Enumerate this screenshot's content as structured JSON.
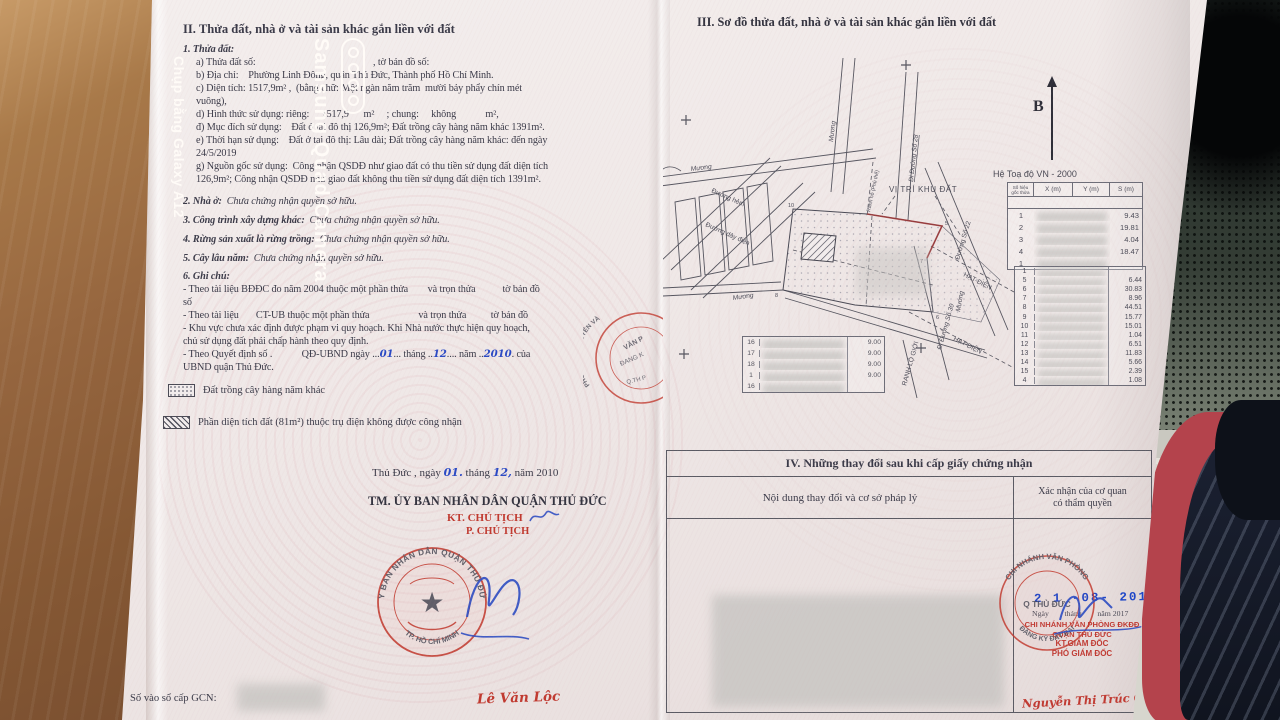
{
  "photo_watermark": {
    "title": "Samsung Quad Camera",
    "subtitle": "Chụp bằng Galaxy A12"
  },
  "left_page": {
    "heading": "II. Thửa đất, nhà ở và tài sản khác gắn liền với đất",
    "parcel": {
      "label": "1. Thửa đất:",
      "line_a": "a) Thửa đất số:                                                , tờ bản đồ số:",
      "line_b": "b) Địa chỉ:    Phường Linh Đông, quận Thủ Đức, Thành phố Hồ Chí Minh.",
      "line_c1": "c) Diện tích: 1517,9m² ,  (bằng chữ: Một ngàn năm trăm  mười bảy phẩy chín mét",
      "line_c2": "vuông),",
      "line_d": "d) Hình thức sử dụng: riêng:     1517,9      m²     ; chung:     không            m²,",
      "line_dd": "đ) Mục đích sử dụng:    Đất ở tại đô thị 126,9m²; Đất trồng cây hàng năm khác 1391m².",
      "line_e1": "e) Thời hạn sử dụng:    Đất ở tại đô thị: Lâu dài; Đất trồng cây hàng năm khác: đến ngày",
      "line_e2": "24/5/2019",
      "line_g1": "g) Nguồn gốc sử dụng:  Công nhận QSDĐ như giao đất có thu tiền sử dụng đất diện tích",
      "line_g2": "126,9m²; Công nhận QSDĐ như giao đất không thu tiền sử dụng đất diện tích 1391m²."
    },
    "item2_label": "2. Nhà ở:",
    "item2_value": "  Chưa chứng nhận quyền sở hữu.",
    "item3_label": "3. Công trình xây dựng khác:",
    "item3_value": "  Chưa chứng nhận quyền sở hữu.",
    "item4_label": "4. Rừng sản xuất là rừng trồng:",
    "item4_value": "  Chưa chứng nhận quyền sở hữu.",
    "item5_label": "5. Cây lâu năm:",
    "item5_value": "  Chưa chứng nhận quyền sở hữu.",
    "item6_label": "6. Ghi chú:",
    "notes": {
      "n1a": "- Theo tài liệu BĐĐC đo năm 2004 thuộc một phần thửa        và trọn thửa           tờ bản đồ",
      "n1b": "số",
      "n2": "- Theo tài liệu       CT-UB thuộc một phần thửa                    và trọn thửa          tờ bản đồ",
      "n3a": "- Khu vực chưa xác định được phạm vi quy hoạch. Khi Nhà nước thực hiện quy hoạch,",
      "n3b": "chủ sử dụng đất phải chấp hành theo quy định.",
      "n4_pre": "- Theo Quyết định số .            QĐ-UBND ngày ...",
      "n4_day": "01",
      "n4_m1": "... tháng ..",
      "n4_month": "12",
      "n4_m2": ".... năm ..",
      "n4_year": "2010",
      "n4_post": ". của",
      "n4b": "UBND quận Thủ Đức."
    },
    "legend": [
      {
        "label": "Đất trồng cây hàng năm khác"
      },
      {
        "label": "Phần diện tích đất (81m²) thuộc trụ điện không được công nhận"
      }
    ],
    "signing": {
      "place_pre": "Thủ Đức , ngày ",
      "day": "01.",
      "thang": " tháng ",
      "month": "12,",
      "nam_year": " năm 2010",
      "committee": "TM. ỦY BAN NHÂN DÂN QUẬN THỦ ĐỨC",
      "kt_line": "KT. CHỦ TỊCH",
      "p_line": "P. CHỦ TỊCH",
      "signer": "Lê Văn Lộc"
    },
    "stamp": {
      "arc_top": "ỦY BAN NHÂN DÂN QUẬN THỦ ĐỨC",
      "arc_bottom": "TP. HỒ CHÍ MINH",
      "star": "★"
    },
    "side_stamp": {
      "arc": "PHÒNG TÀI NGUYÊN VÀ",
      "l1": "VĂN P",
      "l2": "ĐANG K",
      "l3": "Q.TH P"
    },
    "gcn_label": "Số vào sổ cấp GCN:"
  },
  "right_page": {
    "heading": "III. Sơ đồ thửa đất, nhà ở và tài sản khác gắn liền với đất",
    "north_label": "B",
    "coord_title": "Hệ Toạ độ VN - 2000",
    "table1": {
      "col0a": "Số hiệu",
      "col0b": "gốc thửa",
      "col1": "X (m)",
      "col2": "Y (m)",
      "col3": "S (m)",
      "rows": [
        [
          "1",
          "9.43"
        ],
        [
          "2",
          "19.81"
        ],
        [
          "3",
          "4.04"
        ],
        [
          "4",
          "18.47"
        ],
        [
          "1",
          ""
        ]
      ]
    },
    "table2": {
      "rows": [
        [
          "1",
          ""
        ],
        [
          "5",
          "6.44"
        ],
        [
          "6",
          "30.83"
        ],
        [
          "7",
          "8.96"
        ],
        [
          "8",
          "44.51"
        ],
        [
          "9",
          "15.77"
        ],
        [
          "10",
          "15.01"
        ],
        [
          "11",
          "1.04"
        ],
        [
          "12",
          "6.51"
        ],
        [
          "13",
          "11.83"
        ],
        [
          "14",
          "5.66"
        ],
        [
          "15",
          "2.39"
        ],
        [
          "4",
          "1.08"
        ]
      ]
    },
    "dim_table": {
      "rows": [
        [
          "16",
          "9.00"
        ],
        [
          "17",
          "9.00"
        ],
        [
          "18",
          "9.00"
        ],
        [
          "1",
          "9.00"
        ],
        [
          "16",
          ""
        ]
      ]
    },
    "map_labels": {
      "muong_top": "Mương",
      "muong_mid": "Mương",
      "muong_low": "Mương",
      "muong_right": "Mương",
      "road_hem": "Đường hẻm",
      "road_power": "Đường dây điện",
      "road28": "Đi Đường Số 28",
      "ranh_ho": "Ranh hồ (Phủ thế)",
      "site": "VỊ TRÍ KHU ĐẤT",
      "road22": "Đường Số 22",
      "hat1": "HẠT-ĐIỆN",
      "hat2": "HẠT-ĐIỆN",
      "road30": "Đi Đường Số 30",
      "ranh_lo": "RANH LỘ GIỚI",
      "v10": "10",
      "v5": "5",
      "v7": "7",
      "v6": "6",
      "v8": "8"
    },
    "section4": {
      "title": "IV. Những thay đổi sau khi cấp giấy chứng nhận",
      "col1": "Nội dung thay đổi và cơ sở pháp lý",
      "col2a": "Xác nhận của cơ quan",
      "col2b": "có thẩm quyền",
      "date_stamp": "2 1 -08- 2017",
      "date_line": "Ngày        tháng        năm 2017",
      "org1": "CHI NHÁNH VĂN PHÒNG ĐKĐĐ",
      "org2": "QUẬN THỦ ĐỨC",
      "kt": "KT.GIÁM ĐỐC",
      "role": "PHÓ GIÁM ĐỐC",
      "signer": "Nguyễn Thị Trúc Cẩm",
      "stamp": {
        "arc_top": "CHI NHÁNH VĂN PHÒNG",
        "arc_bottom": "ĐĂNG KÝ ĐẤT ĐAI",
        "center": "Q THỦ ĐỨC"
      }
    }
  }
}
